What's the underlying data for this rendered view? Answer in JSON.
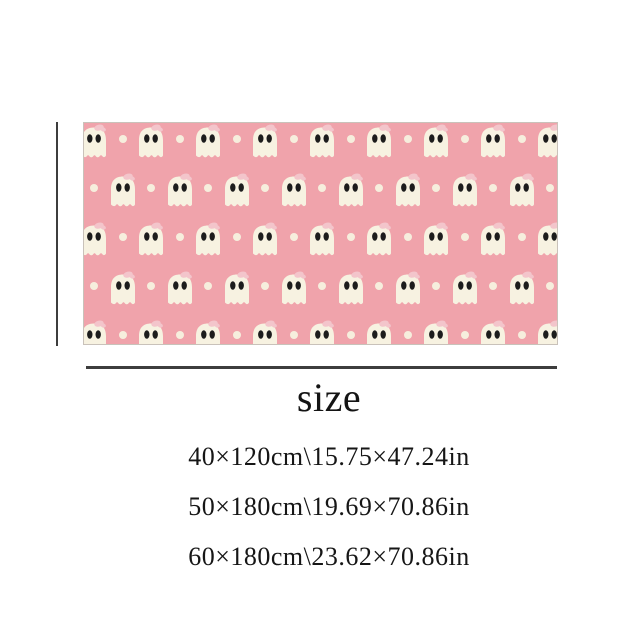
{
  "colors": {
    "page_bg": "#ffffff",
    "rug_pink": "#f0a3ab",
    "ghost_cream": "#f7f2e1",
    "dot_cream": "#f6eedd",
    "eye_black": "#1c1c1c",
    "bow_pink": "#f3c5cb",
    "rug_edge": "#c9c2ba",
    "line_dark": "#3d3d3d",
    "text_dark": "#141414"
  },
  "rug_pattern": {
    "rows": 5,
    "row_height": 49,
    "col_spacing": 57,
    "first_row_center_y": 19,
    "row_a_offset": 10,
    "row_b_offset": 38.5,
    "ghost_w": 28,
    "ghost_h": 36,
    "dot_d": 8,
    "width": 473,
    "height": 221
  },
  "size_section": {
    "heading": "size",
    "options": [
      "40×120cm\\15.75×47.24in",
      "50×180cm\\19.69×70.86in",
      "60×180cm\\23.62×70.86in"
    ]
  }
}
